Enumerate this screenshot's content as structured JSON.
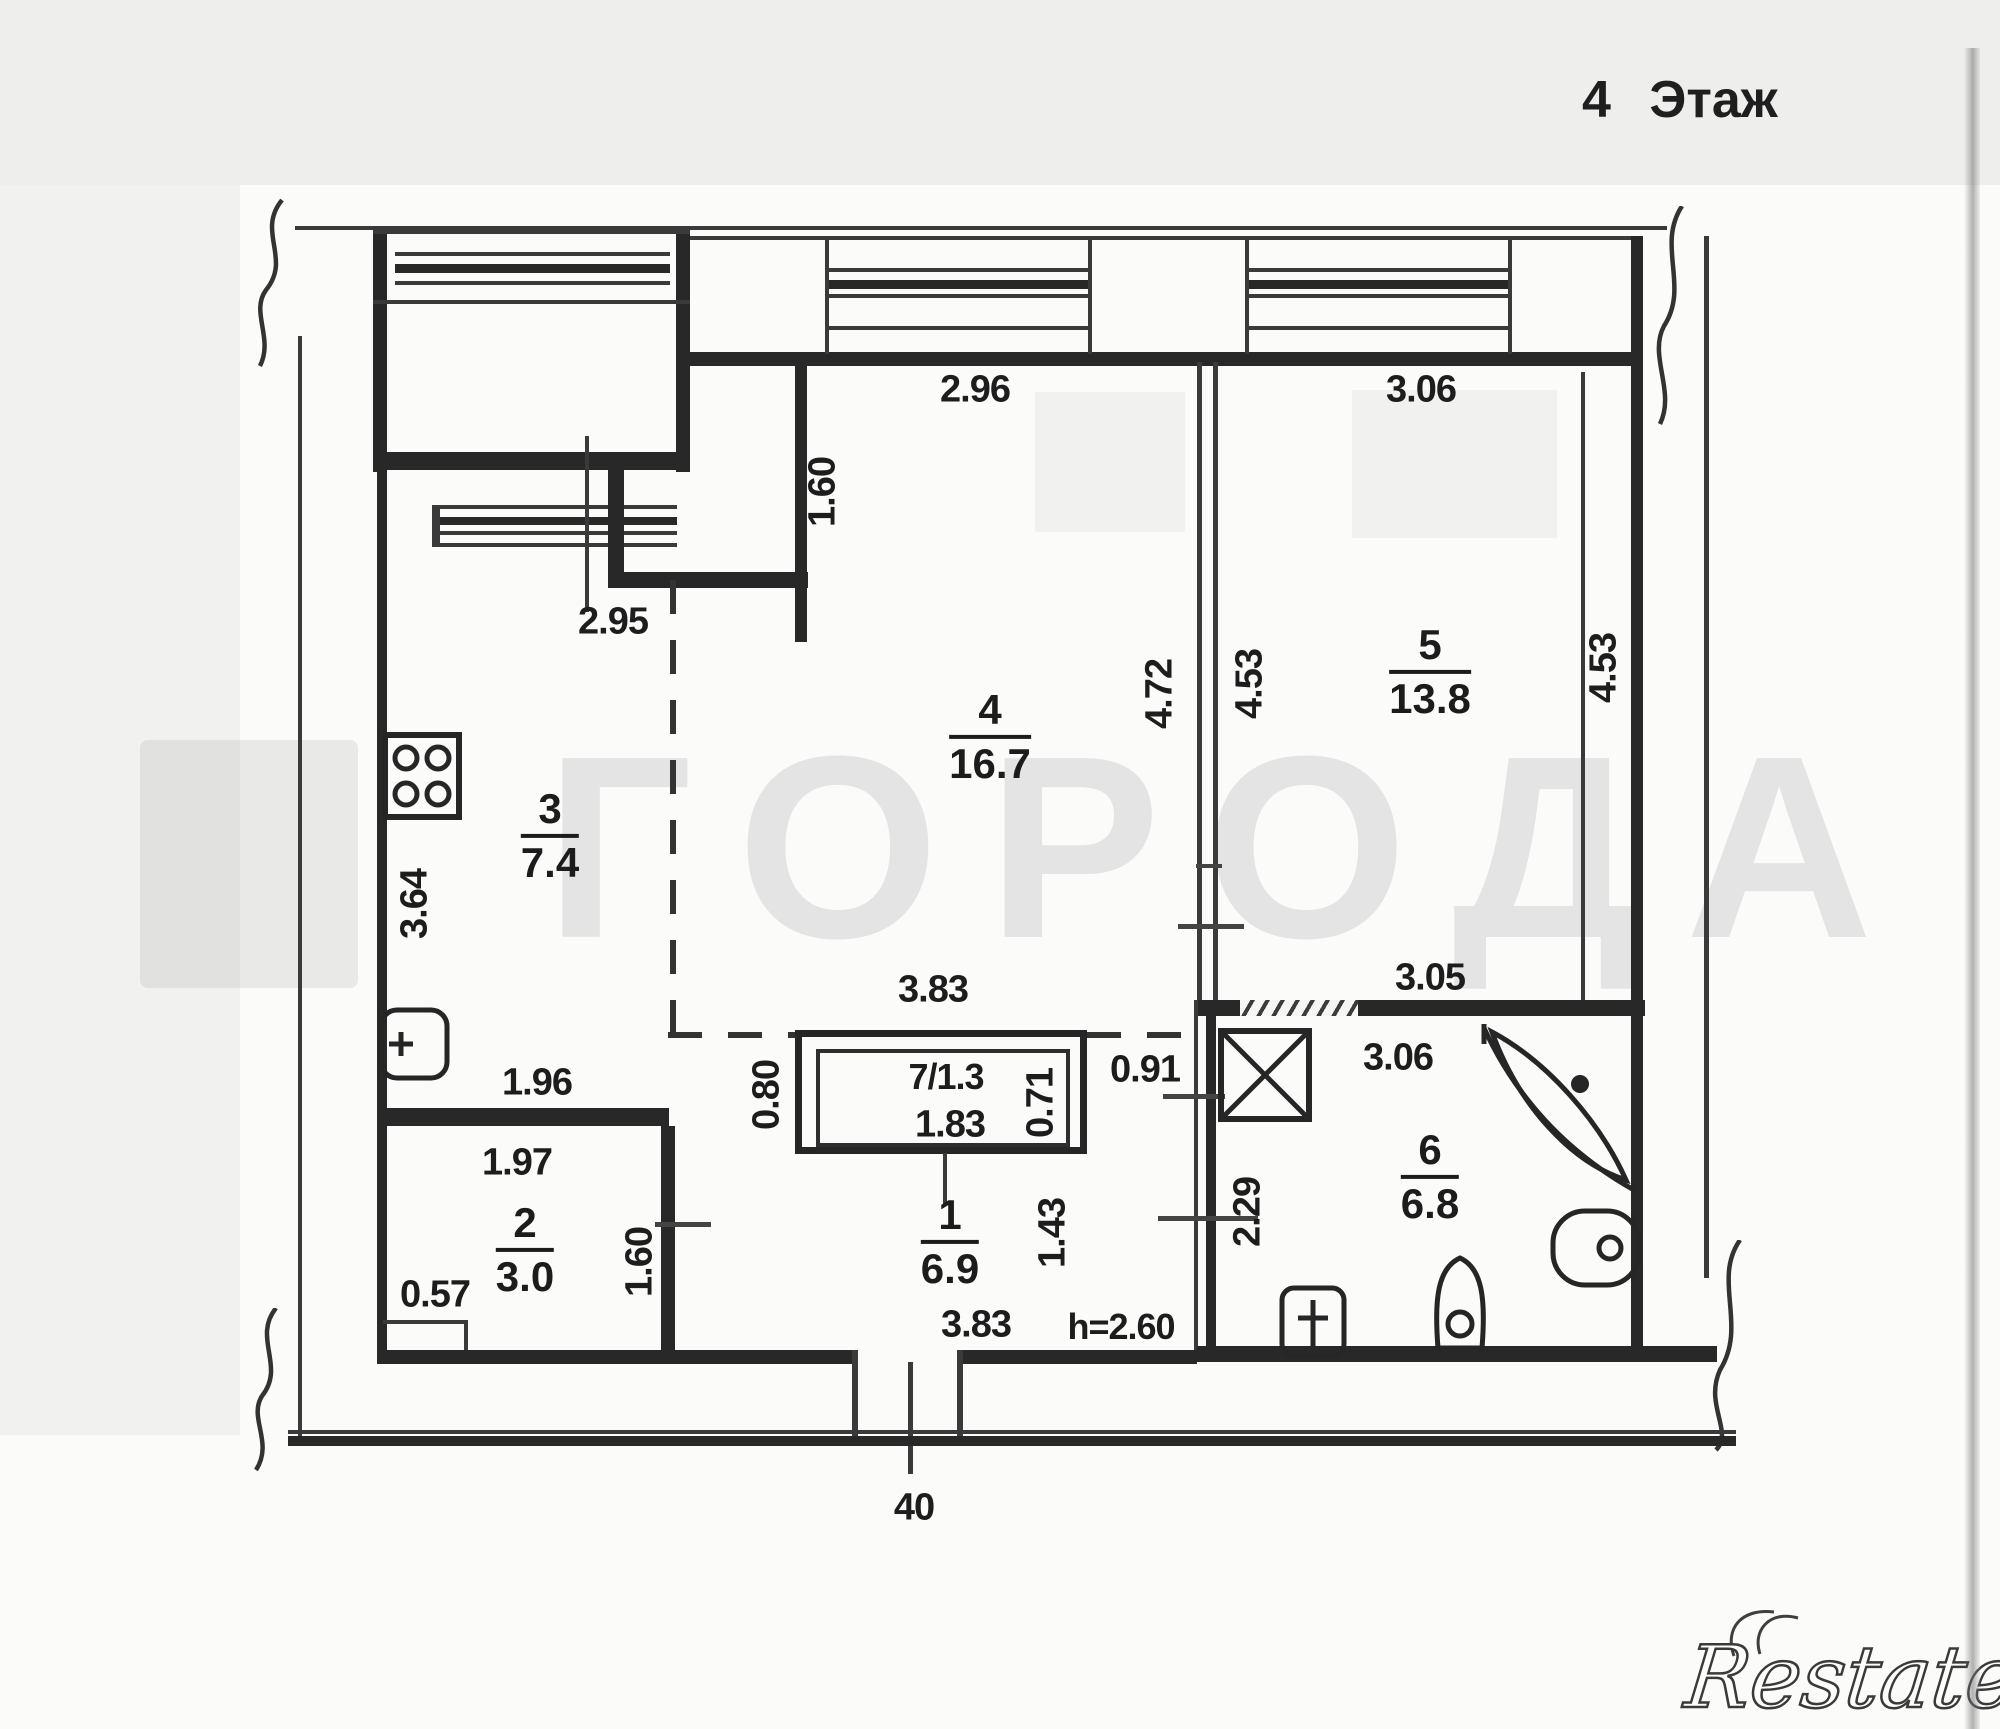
{
  "page": {
    "title": "4 Этаж"
  },
  "watermark": {
    "text": "ГОРОДА"
  },
  "brand": {
    "name": "Restate"
  },
  "rooms": {
    "r1": {
      "number": "1",
      "area": "6.9"
    },
    "r2": {
      "number": "2",
      "area": "3.0"
    },
    "r3": {
      "number": "3",
      "area": "7.4"
    },
    "r4": {
      "number": "4",
      "area": "16.7"
    },
    "r5": {
      "number": "5",
      "area": "13.8"
    },
    "r6": {
      "number": "6",
      "area": "6.8"
    },
    "r7": {
      "label": "7/1.3"
    }
  },
  "dims": {
    "win4_w": "2.96",
    "win5_w": "3.06",
    "niche_h": "1.60",
    "kitchen_w": "2.95",
    "room4_h": "4.72",
    "room5_h_left": "4.53",
    "room5_h_right": "4.53",
    "kitchen_h": "3.64",
    "room4_w": "3.83",
    "kitchen_s": "1.96",
    "room2_w": "1.97",
    "room2_s": "0.57",
    "room2_h": "1.60",
    "closet_d": "0.80",
    "pass_w": "0.91",
    "closet_h": "0.71",
    "closet_w": "1.83",
    "hall_h": "1.43",
    "hall_w": "3.83",
    "ceiling": "h=2.60",
    "bath_top_w": "3.05",
    "bath_w": "3.06",
    "bath_h": "2.29",
    "entry": "40"
  }
}
